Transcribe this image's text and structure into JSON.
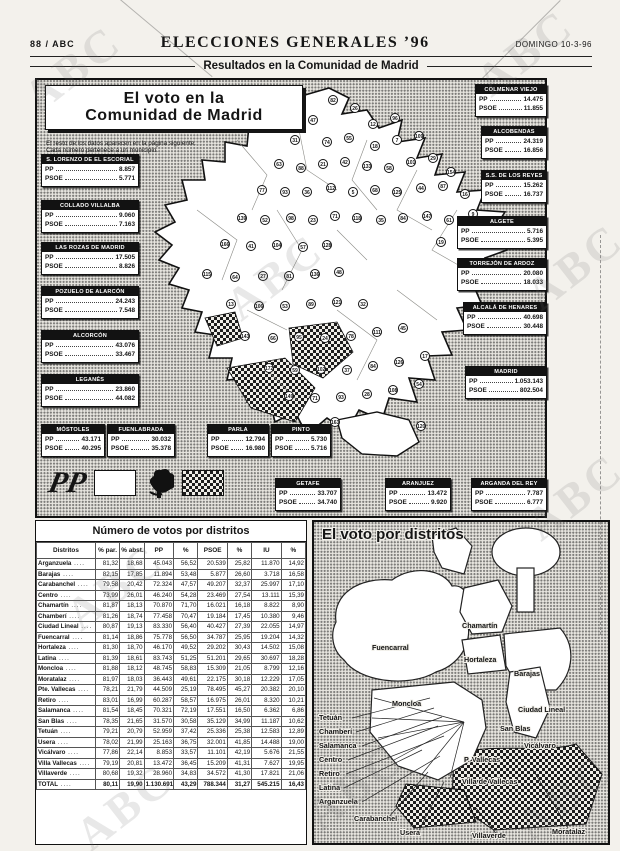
{
  "colors": {
    "paper": "#f3f1ec",
    "ink": "#151515",
    "box_header": "#121212",
    "map_white": "#ffffff"
  },
  "header": {
    "edition": "88 / ABC",
    "title": "ELECCIONES GENERALES ’96",
    "date": "DOMINGO 10-3-96",
    "section": "Resultados en la Comunidad de Madrid",
    "watermark_text": "ABC"
  },
  "region_panel": {
    "title_line1": "El voto en la",
    "title_line2": "Comunidad de Madrid",
    "note1": "El resto de los datos aparecen en la página siguiente.",
    "note2": "Cada número pertenece a un municipio.",
    "party_pp": "PP",
    "party_psoe": "PSOE",
    "legend": {
      "pp_logo": "PP",
      "pp_fill": "white",
      "psoe_logo_icon": "psoe-rose-fist-icon",
      "psoe_fill": "checkered"
    },
    "boxes": [
      {
        "name": "S. LORENZO DE EL ESCORIAL",
        "pp": "8.857",
        "psoe": "5.771",
        "x": 4,
        "y": 74,
        "w": 96
      },
      {
        "name": "COLLADO VILLALBA",
        "pp": "9.060",
        "psoe": "7.163",
        "x": 4,
        "y": 120,
        "w": 96
      },
      {
        "name": "LAS ROZAS DE MADRID",
        "pp": "17.505",
        "psoe": "8.826",
        "x": 4,
        "y": 162,
        "w": 96
      },
      {
        "name": "POZUELO DE ALARCÓN",
        "pp": "24.243",
        "psoe": "7.548",
        "x": 4,
        "y": 206,
        "w": 96
      },
      {
        "name": "ALCORCÓN",
        "pp": "43.076",
        "psoe": "33.467",
        "x": 4,
        "y": 250,
        "w": 96
      },
      {
        "name": "LEGANÉS",
        "pp": "23.860",
        "psoe": "44.082",
        "x": 4,
        "y": 294,
        "w": 96
      },
      {
        "name": "MÓSTOLES",
        "pp": "43.171",
        "psoe": "40.295",
        "x": 4,
        "y": 344,
        "w": 62
      },
      {
        "name": "FUENLABRADA",
        "pp": "30.032",
        "psoe": "35.378",
        "x": 70,
        "y": 344,
        "w": 66
      },
      {
        "name": "PARLA",
        "pp": "12.794",
        "psoe": "16.980",
        "x": 170,
        "y": 344,
        "w": 60
      },
      {
        "name": "PINTO",
        "pp": "5.730",
        "psoe": "5.716",
        "x": 234,
        "y": 344,
        "w": 58
      },
      {
        "name": "GETAFE",
        "pp": "33.707",
        "psoe": "34.740",
        "x": 238,
        "y": 398,
        "w": 64
      },
      {
        "name": "ARANJUEZ",
        "pp": "13.472",
        "psoe": "9.920",
        "x": 348,
        "y": 398,
        "w": 64
      },
      {
        "name": "ARGANDA DEL REY",
        "pp": "7.787",
        "psoe": "6.777",
        "x": 434,
        "y": 398,
        "w": 74
      },
      {
        "name": "COLMENAR VIEJO",
        "pp": "14.475",
        "psoe": "11.855",
        "x": 438,
        "y": 4,
        "w": 70
      },
      {
        "name": "ALCOBENDAS",
        "pp": "24.319",
        "psoe": "16.856",
        "x": 444,
        "y": 46,
        "w": 64
      },
      {
        "name": "S.S. DE LOS REYES",
        "pp": "15.262",
        "psoe": "16.737",
        "x": 444,
        "y": 90,
        "w": 64
      },
      {
        "name": "ALGETE",
        "pp": "5.716",
        "psoe": "5.395",
        "x": 420,
        "y": 136,
        "w": 88
      },
      {
        "name": "TORREJÓN DE ARDOZ",
        "pp": "20.080",
        "psoe": "18.033",
        "x": 420,
        "y": 178,
        "w": 88
      },
      {
        "name": "ALCALÁ DE HENARES",
        "pp": "40.698",
        "psoe": "30.448",
        "x": 426,
        "y": 222,
        "w": 82
      },
      {
        "name": "MADRID",
        "pp": "1.053.143",
        "psoe": "802.504",
        "x": 428,
        "y": 286,
        "w": 80
      }
    ],
    "circles": [
      [
        82,
        296,
        20
      ],
      [
        26,
        318,
        28
      ],
      [
        47,
        276,
        40
      ],
      [
        12,
        336,
        44
      ],
      [
        96,
        358,
        38
      ],
      [
        31,
        258,
        60
      ],
      [
        74,
        290,
        62
      ],
      [
        55,
        312,
        58
      ],
      [
        18,
        338,
        66
      ],
      [
        7,
        360,
        60
      ],
      [
        109,
        382,
        56
      ],
      [
        63,
        242,
        84
      ],
      [
        88,
        264,
        88
      ],
      [
        21,
        286,
        84
      ],
      [
        42,
        308,
        82
      ],
      [
        133,
        330,
        86
      ],
      [
        58,
        352,
        88
      ],
      [
        101,
        374,
        82
      ],
      [
        29,
        396,
        78
      ],
      [
        154,
        414,
        92
      ],
      [
        77,
        225,
        110
      ],
      [
        93,
        248,
        112
      ],
      [
        36,
        270,
        112
      ],
      [
        112,
        294,
        108
      ],
      [
        5,
        316,
        112
      ],
      [
        68,
        338,
        110
      ],
      [
        125,
        360,
        112
      ],
      [
        44,
        384,
        108
      ],
      [
        87,
        406,
        106
      ],
      [
        16,
        428,
        114
      ],
      [
        139,
        205,
        138
      ],
      [
        52,
        228,
        140
      ],
      [
        98,
        254,
        138
      ],
      [
        23,
        276,
        140
      ],
      [
        71,
        298,
        136
      ],
      [
        118,
        320,
        138
      ],
      [
        35,
        344,
        140
      ],
      [
        84,
        366,
        138
      ],
      [
        147,
        390,
        136
      ],
      [
        61,
        412,
        140
      ],
      [
        9,
        436,
        134
      ],
      [
        166,
        188,
        164
      ],
      [
        41,
        214,
        166
      ],
      [
        104,
        240,
        165
      ],
      [
        57,
        266,
        167
      ],
      [
        128,
        290,
        165
      ],
      [
        19,
        404,
        162
      ],
      [
        92,
        428,
        158
      ],
      [
        115,
        170,
        194
      ],
      [
        64,
        198,
        197
      ],
      [
        27,
        226,
        196
      ],
      [
        81,
        252,
        196
      ],
      [
        136,
        278,
        194
      ],
      [
        48,
        302,
        192
      ],
      [
        13,
        194,
        224
      ],
      [
        106,
        222,
        226
      ],
      [
        53,
        248,
        226
      ],
      [
        89,
        274,
        224
      ],
      [
        121,
        300,
        222
      ],
      [
        32,
        326,
        224
      ],
      [
        143,
        208,
        256
      ],
      [
        66,
        236,
        258
      ],
      [
        95,
        262,
        257
      ],
      [
        24,
        288,
        258
      ],
      [
        78,
        314,
        256
      ],
      [
        111,
        340,
        252
      ],
      [
        45,
        366,
        248
      ],
      [
        172,
        232,
        288
      ],
      [
        59,
        258,
        290
      ],
      [
        102,
        284,
        289
      ],
      [
        37,
        310,
        290
      ],
      [
        84,
        336,
        286
      ],
      [
        126,
        362,
        282
      ],
      [
        17,
        388,
        276
      ],
      [
        149,
        252,
        316
      ],
      [
        71,
        278,
        318
      ],
      [
        93,
        304,
        317
      ],
      [
        28,
        330,
        314
      ],
      [
        108,
        356,
        310
      ],
      [
        54,
        382,
        304
      ],
      [
        163,
        298,
        342
      ],
      [
        120,
        384,
        346
      ]
    ]
  },
  "table_panel": {
    "title": "Número de votos por distritos",
    "columns": [
      "Distritos",
      "% par.",
      "% abst.",
      "PP",
      "%",
      "PSOE",
      "%",
      "IU",
      "%"
    ],
    "rows": [
      [
        "Arganzuela",
        "81,32",
        "18,68",
        "45.043",
        "56,52",
        "20.539",
        "25,82",
        "11.870",
        "14,92"
      ],
      [
        "Barajas",
        "82,15",
        "17,85",
        "11.894",
        "53,48",
        "5.877",
        "26,60",
        "3.718",
        "16,58"
      ],
      [
        "Carabanchel",
        "79,58",
        "20,42",
        "72.324",
        "47,57",
        "49.207",
        "32,37",
        "25.997",
        "17,10"
      ],
      [
        "Centro",
        "73,99",
        "26,01",
        "46.240",
        "54,28",
        "23.469",
        "27,54",
        "13.111",
        "15,39"
      ],
      [
        "Chamartín",
        "81,87",
        "18,13",
        "70.870",
        "71,70",
        "16.021",
        "16,18",
        "8.822",
        "8,90"
      ],
      [
        "Chamberí",
        "81,26",
        "18,74",
        "77.458",
        "70,47",
        "19.184",
        "17,45",
        "10.380",
        "9,46"
      ],
      [
        "Ciudad Lineal",
        "80,87",
        "19,13",
        "83.330",
        "56,40",
        "40.427",
        "27,39",
        "22.055",
        "14,97"
      ],
      [
        "Fuencarral",
        "81,14",
        "18,86",
        "75.778",
        "56,50",
        "34.787",
        "25,95",
        "19.204",
        "14,32"
      ],
      [
        "Hortaleza",
        "81,30",
        "18,70",
        "46.170",
        "49,52",
        "29.202",
        "30,43",
        "14.502",
        "15,08"
      ],
      [
        "Latina",
        "81,39",
        "18,61",
        "83.743",
        "51,25",
        "51.201",
        "29,65",
        "30.697",
        "18,28"
      ],
      [
        "Moncloa",
        "81,88",
        "18,12",
        "48.745",
        "58,83",
        "15.309",
        "21,05",
        "8.799",
        "12,16"
      ],
      [
        "Moratalaz",
        "81,97",
        "18,03",
        "36.443",
        "49,61",
        "22.175",
        "30,18",
        "12.229",
        "17,05"
      ],
      [
        "Pte. Vallecas",
        "78,21",
        "21,79",
        "44.509",
        "25,19",
        "78.495",
        "45,27",
        "20.382",
        "20,10"
      ],
      [
        "Retiro",
        "83,01",
        "16,99",
        "60.287",
        "58,57",
        "16.975",
        "26,01",
        "8.320",
        "10,21"
      ],
      [
        "Salamanca",
        "81,54",
        "18,45",
        "70.321",
        "72,19",
        "17.551",
        "16,50",
        "6.362",
        "6,86"
      ],
      [
        "San Blas",
        "78,35",
        "21,65",
        "31.570",
        "30,58",
        "35.129",
        "34,99",
        "11.187",
        "10,62"
      ],
      [
        "Tetuán",
        "79,21",
        "20,79",
        "52.959",
        "37,42",
        "25.336",
        "25,38",
        "12.583",
        "12,89"
      ],
      [
        "Usera",
        "78,02",
        "21,99",
        "25.163",
        "36,75",
        "32.001",
        "41,85",
        "14.488",
        "19,00"
      ],
      [
        "Vicálvaro",
        "77,86",
        "22,14",
        "8.853",
        "33,57",
        "11.101",
        "42,19",
        "5.676",
        "21,55"
      ],
      [
        "Villa Vallecas",
        "79,19",
        "20,81",
        "13.472",
        "36,45",
        "15.209",
        "41,31",
        "7.627",
        "19,95"
      ],
      [
        "Villaverde",
        "80,68",
        "19,32",
        "28.960",
        "34,83",
        "34.572",
        "41,30",
        "17.821",
        "21,06"
      ],
      [
        "TOTAL",
        "80,11",
        "19,90",
        "1.130.691",
        "43,29",
        "788.344",
        "31,27",
        "545.215",
        "16,43"
      ]
    ],
    "total_label": "TOTAL"
  },
  "district_panel": {
    "title": "El voto por distritos",
    "labels": [
      {
        "t": "Fuencarral",
        "x": 58,
        "y": 128
      },
      {
        "t": "Chamartín",
        "x": 148,
        "y": 106
      },
      {
        "t": "Hortaleza",
        "x": 150,
        "y": 140
      },
      {
        "t": "Barajas",
        "x": 200,
        "y": 154
      },
      {
        "t": "Moncloa",
        "x": 78,
        "y": 184
      },
      {
        "t": "Ciudad Lineal",
        "x": 204,
        "y": 190
      },
      {
        "t": "San Blas",
        "x": 186,
        "y": 209
      },
      {
        "t": "Vicálvaro",
        "x": 210,
        "y": 226
      },
      {
        "t": "Tetuán",
        "x": 5,
        "y": 198
      },
      {
        "t": "Chamberí",
        "x": 5,
        "y": 212
      },
      {
        "t": "Salamanca",
        "x": 5,
        "y": 226
      },
      {
        "t": "Centro",
        "x": 5,
        "y": 240
      },
      {
        "t": "Retiro",
        "x": 5,
        "y": 254
      },
      {
        "t": "Latina",
        "x": 5,
        "y": 268
      },
      {
        "t": "Arganzuela",
        "x": 5,
        "y": 282
      },
      {
        "t": "Carabanchel",
        "x": 40,
        "y": 299
      },
      {
        "t": "Usera",
        "x": 86,
        "y": 313
      },
      {
        "t": "P. Vallecas",
        "x": 150,
        "y": 240
      },
      {
        "t": "Villa de Vallecas",
        "x": 148,
        "y": 262
      },
      {
        "t": "Villaverde",
        "x": 158,
        "y": 316
      },
      {
        "t": "Moratalaz",
        "x": 238,
        "y": 312
      }
    ],
    "lines": [
      [
        38,
        196,
        116,
        176
      ],
      [
        42,
        210,
        120,
        186
      ],
      [
        48,
        224,
        128,
        195
      ],
      [
        34,
        238,
        124,
        204
      ],
      [
        32,
        252,
        130,
        214
      ],
      [
        30,
        266,
        108,
        228
      ],
      [
        48,
        280,
        126,
        234
      ],
      [
        74,
        296,
        114,
        250
      ],
      [
        104,
        310,
        130,
        260
      ],
      [
        254,
        306,
        218,
        246
      ],
      [
        184,
        314,
        162,
        286
      ]
    ]
  }
}
